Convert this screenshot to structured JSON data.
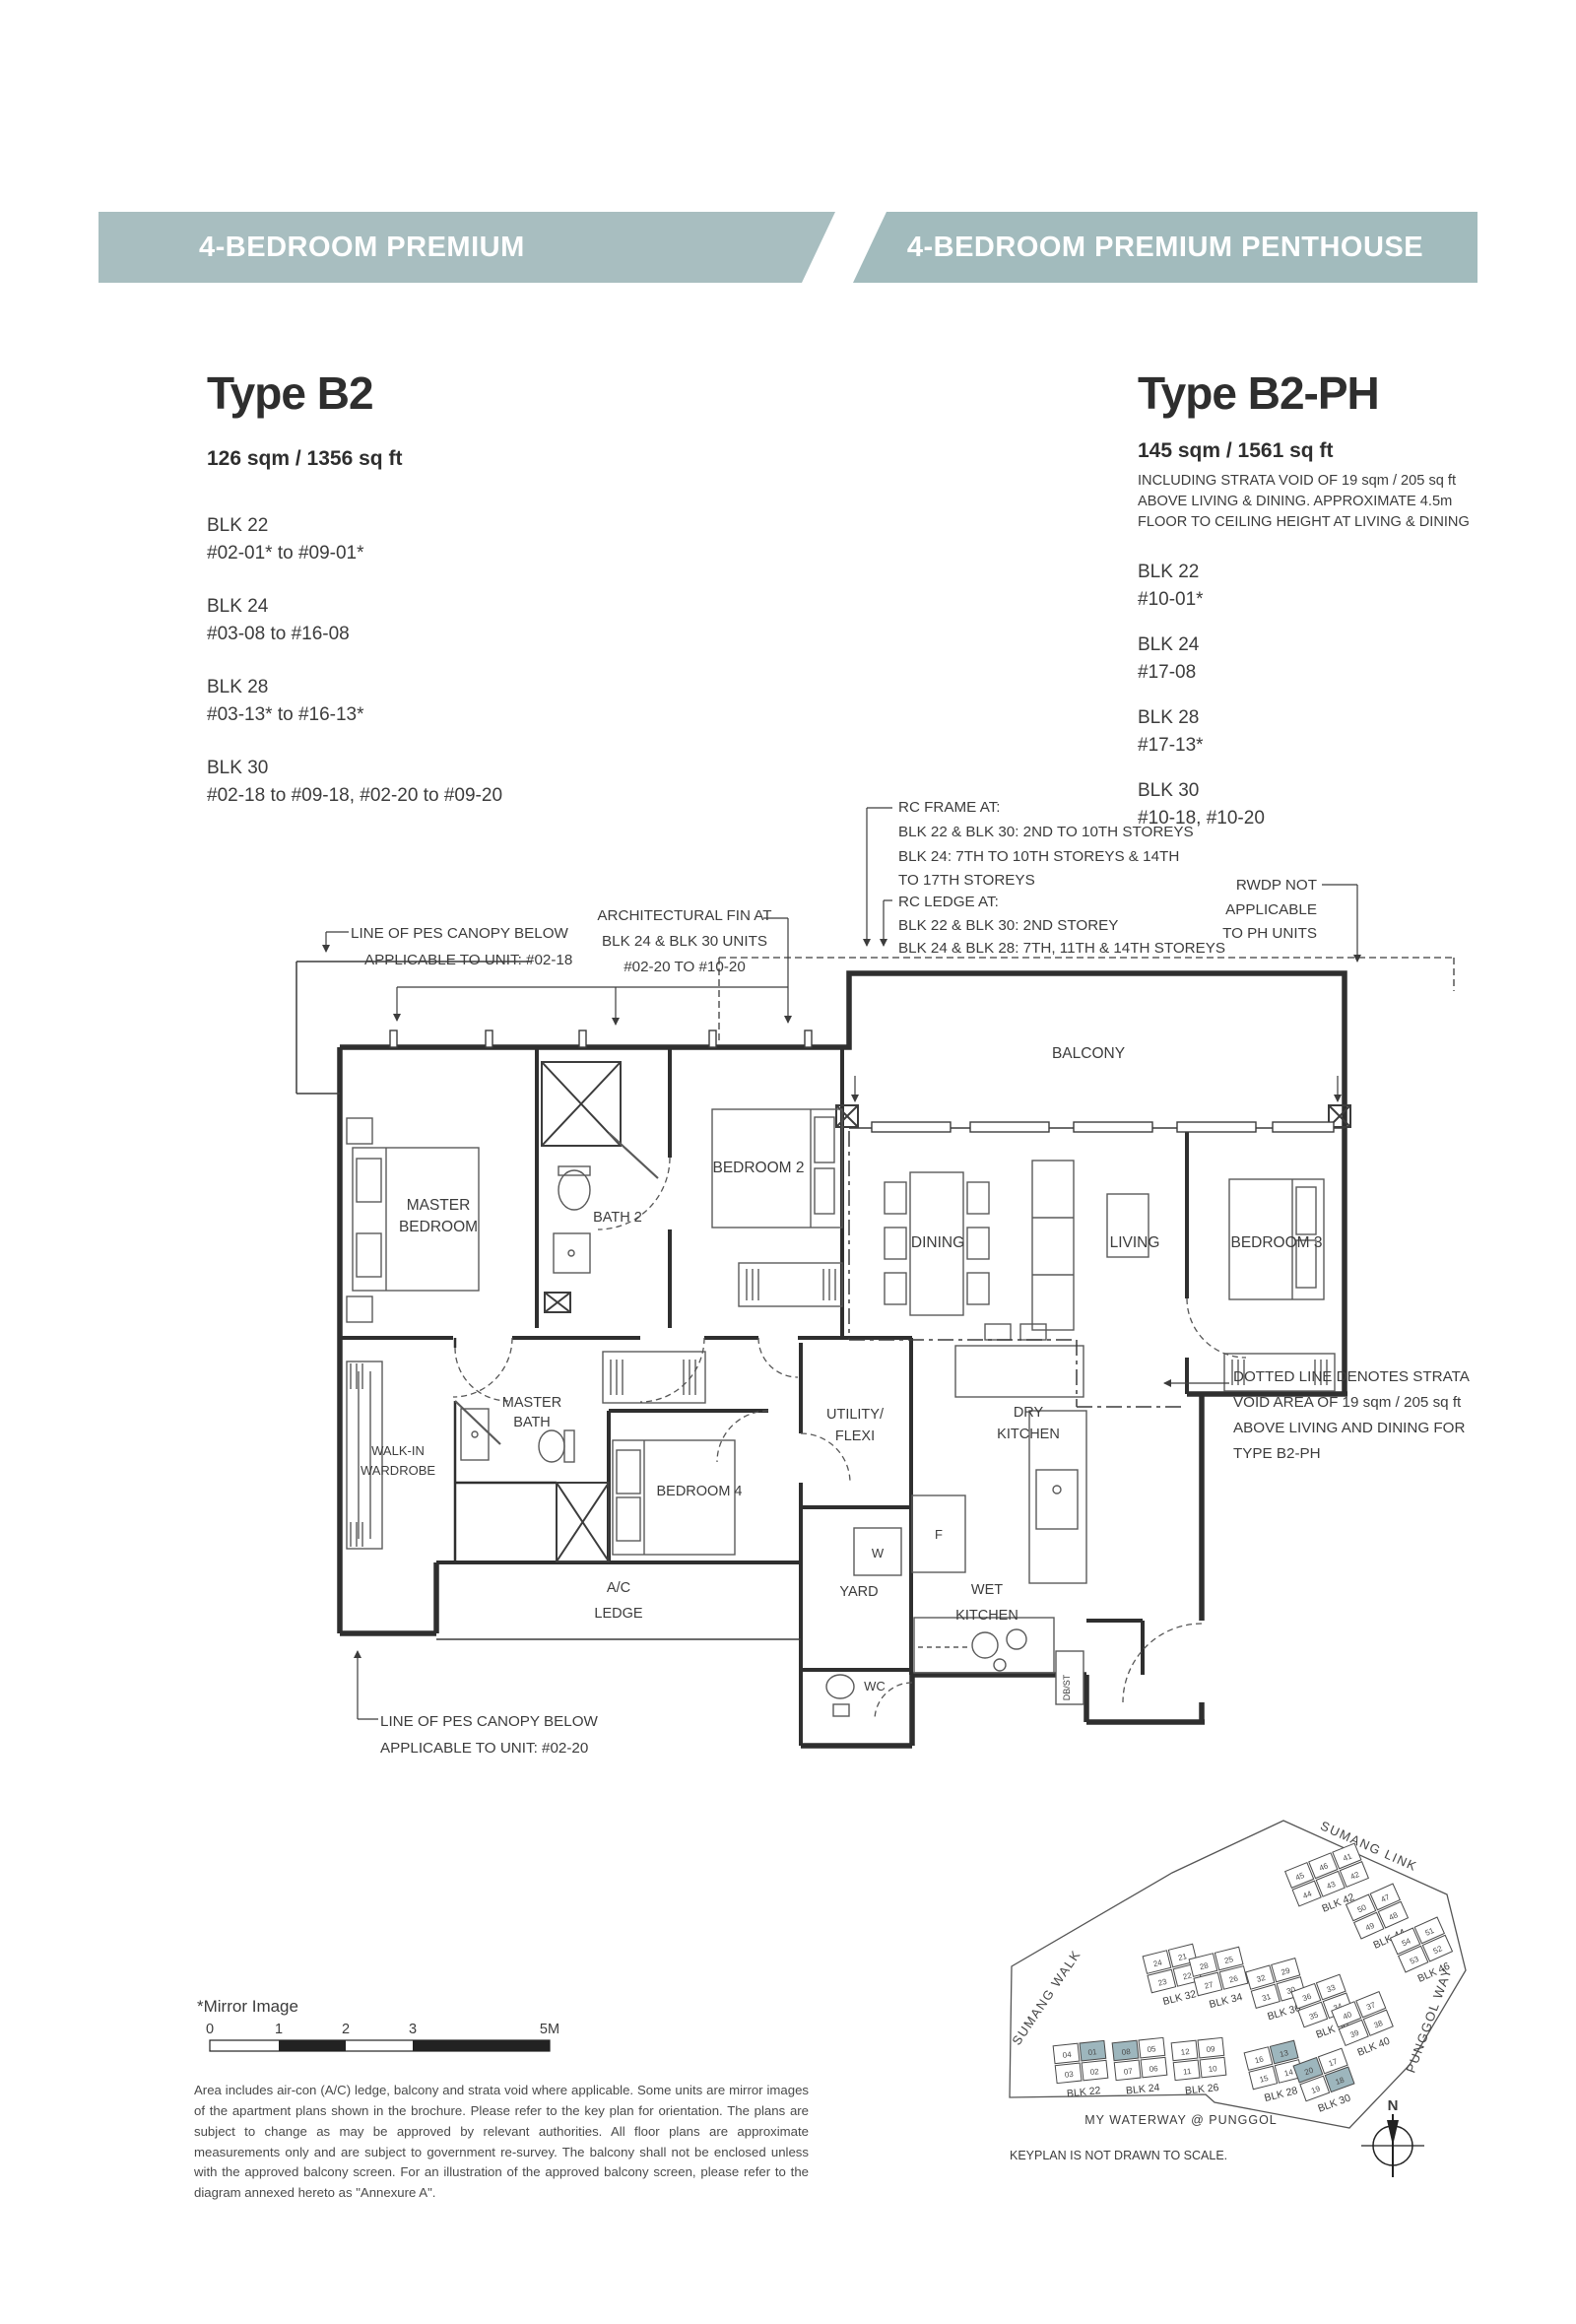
{
  "banner": {
    "left": "4-BEDROOM PREMIUM",
    "right": "4-BEDROOM PREMIUM PENTHOUSE"
  },
  "colors": {
    "banner_left": "#a8bec0",
    "banner_right": "#a2bbbd",
    "keyplan_highlight": "#9db6bd",
    "line": "#3c3c3c"
  },
  "type_b2": {
    "title": "Type B2",
    "area": "126 sqm / 1356 sq ft",
    "blocks": [
      {
        "blk": "BLK 22",
        "units": "#02-01* to #09-01*"
      },
      {
        "blk": "BLK 24",
        "units": "#03-08 to #16-08"
      },
      {
        "blk": "BLK 28",
        "units": "#03-13* to #16-13*"
      },
      {
        "blk": "BLK 30",
        "units": "#02-18 to #09-18, #02-20 to #09-20"
      }
    ]
  },
  "type_b2ph": {
    "title": "Type B2-PH",
    "area": "145 sqm / 1561 sq ft",
    "area_note_1": "INCLUDING STRATA VOID OF 19 sqm / 205 sq ft",
    "area_note_2": "ABOVE LIVING & DINING. APPROXIMATE 4.5m",
    "area_note_3": "FLOOR TO CEILING HEIGHT AT LIVING & DINING",
    "blocks": [
      {
        "blk": "BLK 22",
        "units": "#10-01*"
      },
      {
        "blk": "BLK 24",
        "units": "#17-08"
      },
      {
        "blk": "BLK 28",
        "units": "#17-13*"
      },
      {
        "blk": "BLK 30",
        "units": "#10-18, #10-20"
      }
    ]
  },
  "annotations": {
    "pes18_1": "LINE OF PES CANOPY BELOW",
    "pes18_2": "APPLICABLE TO UNIT: #02-18",
    "archfin_1": "ARCHITECTURAL FIN AT",
    "archfin_2": "BLK 24 & BLK 30 UNITS",
    "archfin_3": "#02-20 TO #10-20",
    "rcframe_1": "RC FRAME AT:",
    "rcframe_2": "BLK 22 & BLK 30: 2ND TO 10TH STOREYS",
    "rcframe_3": "BLK 24: 7TH TO 10TH STOREYS & 14TH",
    "rcframe_4": "TO 17TH STOREYS",
    "rcledge_1": "RC LEDGE AT:",
    "rcledge_2": "BLK 22 & BLK 30: 2ND STOREY",
    "rcledge_3": "BLK 24 & BLK 28: 7TH, 11TH & 14TH STOREYS",
    "rwdp_1": "RWDP NOT",
    "rwdp_2": "APPLICABLE",
    "rwdp_3": "TO PH UNITS",
    "strata_1": "DOTTED LINE DENOTES STRATA",
    "strata_2": "VOID AREA OF 19 sqm / 205 sq ft",
    "strata_3": "ABOVE LIVING AND DINING FOR",
    "strata_4": "TYPE B2-PH",
    "pes20_1": "LINE OF PES CANOPY BELOW",
    "pes20_2": "APPLICABLE TO UNIT: #02-20"
  },
  "rooms": {
    "master_1": "MASTER",
    "master_2": "BEDROOM",
    "bath2": "BATH 2",
    "bedroom2": "BEDROOM 2",
    "balcony": "BALCONY",
    "dining": "DINING",
    "living": "LIVING",
    "bedroom3": "BEDROOM 3",
    "walkin_1": "WALK-IN",
    "walkin_2": "WARDROBE",
    "mbath_1": "MASTER",
    "mbath_2": "BATH",
    "bedroom4": "BEDROOM 4",
    "utility_1": "UTILITY/",
    "utility_2": "FLEXI",
    "ac_1": "A/C",
    "ac_2": "LEDGE",
    "yard": "YARD",
    "wc": "WC",
    "dry_1": "DRY",
    "dry_2": "KITCHEN",
    "wet_1": "WET",
    "wet_2": "KITCHEN",
    "w": "W",
    "f": "F",
    "dbst": "DB/ST"
  },
  "footer": {
    "mirror": "*Mirror Image",
    "scale": [
      "0",
      "1",
      "2",
      "3",
      "5M"
    ],
    "disclaimer": "Area includes air-con (A/C) ledge, balcony and strata void where applicable. Some units are mirror images of the apartment plans shown in the brochure. Please refer to the key plan for orientation. The plans are subject to change as may be approved by relevant authorities. All floor plans are approximate measurements only and are subject to government re-survey. The balcony shall not be enclosed unless with the approved balcony screen. For an illustration of the approved balcony screen, please refer to the diagram annexed hereto as \"Annexure A\"."
  },
  "keyplan": {
    "roads": {
      "sumang_link": "SUMANG LINK",
      "sumang_walk": "SUMANG WALK",
      "punggol_way": "PUNGGOL WAY"
    },
    "project": "MY  WATERWAY  @  PUNGGOL",
    "note": "KEYPLAN IS NOT DRAWN TO SCALE.",
    "north": "N",
    "blocks": [
      {
        "label": "BLK 22",
        "units": [
          "04",
          "01",
          "03",
          "02"
        ],
        "highlighted": [
          "01"
        ]
      },
      {
        "label": "BLK 24",
        "units": [
          "08",
          "05",
          "07",
          "06"
        ],
        "highlighted": [
          "08"
        ]
      },
      {
        "label": "BLK 26",
        "units": [
          "12",
          "09",
          "11",
          "10"
        ],
        "highlighted": []
      },
      {
        "label": "BLK 28",
        "units": [
          "16",
          "13",
          "15",
          "14"
        ],
        "highlighted": [
          "13"
        ]
      },
      {
        "label": "BLK 30",
        "units": [
          "20",
          "17",
          "19",
          "18"
        ],
        "highlighted": [
          "20",
          "18"
        ]
      },
      {
        "label": "BLK 32",
        "units": [
          "24",
          "21",
          "23",
          "22"
        ],
        "highlighted": []
      },
      {
        "label": "BLK 34",
        "units": [
          "28",
          "25",
          "27",
          "26"
        ],
        "highlighted": []
      },
      {
        "label": "BLK 36",
        "units": [
          "32",
          "29",
          "31",
          "30"
        ],
        "highlighted": []
      },
      {
        "label": "BLK 38",
        "units": [
          "36",
          "33",
          "35",
          "34"
        ],
        "highlighted": []
      },
      {
        "label": "BLK 40",
        "units": [
          "40",
          "37",
          "39",
          "38"
        ],
        "highlighted": []
      },
      {
        "label": "BLK 42",
        "units": [
          "45",
          "46",
          "41",
          "44",
          "43",
          "42"
        ],
        "highlighted": []
      },
      {
        "label": "BLK 44",
        "units": [
          "50",
          "47",
          "49",
          "48"
        ],
        "highlighted": []
      },
      {
        "label": "BLK 46",
        "units": [
          "54",
          "51",
          "53",
          "52"
        ],
        "highlighted": []
      }
    ]
  }
}
